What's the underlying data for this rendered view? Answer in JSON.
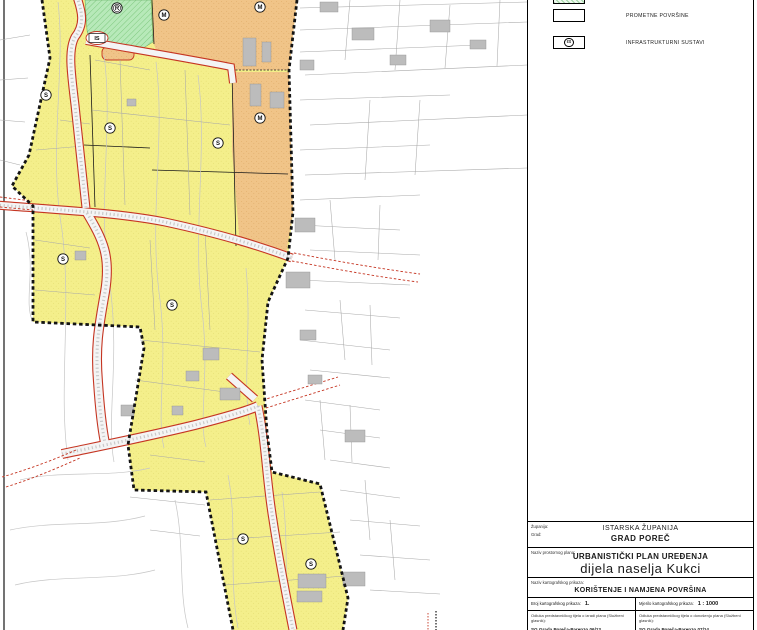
{
  "colors": {
    "yellow": "#f4ef8b",
    "orange": "#f0c488",
    "green": "#b7e9b9",
    "roadred": "#c53522",
    "boundary": "#141414",
    "building": "#bcbcbc",
    "parcel": "#a9a9a9",
    "contour": "#c6c6c6"
  },
  "legend": {
    "items": [
      {
        "label": "",
        "swatch": "hatched"
      },
      {
        "label": "PROMETNE POVRŠINE",
        "swatch": "plain"
      },
      {
        "label": "INFRASTRUKTURNI SUSTAVI",
        "swatch": "is"
      }
    ],
    "is_symbol": "IS"
  },
  "title_block": {
    "zupanija_label": "Županija:",
    "zupanija": "ISTARSKA ŽUPANIJA",
    "grad_label": "Grad:",
    "grad": "GRAD POREČ",
    "plan_label": "Naziv prostornog plana:",
    "plan_line1": "URBANISTIČKI PLAN UREĐENJA",
    "plan_line2": "dijela naselja Kukci",
    "karta_label": "Naziv kartografskog prikaza:",
    "karta": "KORIŠTENJE I NAMJENA POVRŠINA",
    "broj_label": "Broj kartografskog prikaza:",
    "broj": "1.",
    "mjerilo_label": "Mjerilo kartografskog prikaza:",
    "mjerilo": "1 : 1000",
    "odluka_izrada_label": "Odluka predstavničkog tijela o izradi plana (Službeni glasnik):",
    "odluka_izrada": "SG Grada Poreča-Parenzo 06/13",
    "odluka_donosenje_label": "Odluka predstavničkog tijela o donošenju plana (Službeni glasnik):",
    "odluka_donosenje": "SG Grada Poreča-Parenzo 07/14"
  },
  "map": {
    "zone_labels": [
      {
        "letter": "S",
        "x": 46,
        "y": 95
      },
      {
        "letter": "S",
        "x": 110,
        "y": 128
      },
      {
        "letter": "S",
        "x": 218,
        "y": 143
      },
      {
        "letter": "S",
        "x": 63,
        "y": 259
      },
      {
        "letter": "S",
        "x": 172,
        "y": 305
      },
      {
        "letter": "S",
        "x": 243,
        "y": 539
      },
      {
        "letter": "S",
        "x": 311,
        "y": 564
      },
      {
        "letter": "M",
        "x": 164,
        "y": 15
      },
      {
        "letter": "M",
        "x": 260,
        "y": 7
      },
      {
        "letter": "M",
        "x": 260,
        "y": 118
      },
      {
        "letter": "R",
        "x": 117,
        "y": 8,
        "double": true
      }
    ],
    "is_box": {
      "label": "IS",
      "x": 97,
      "y": 38
    }
  }
}
